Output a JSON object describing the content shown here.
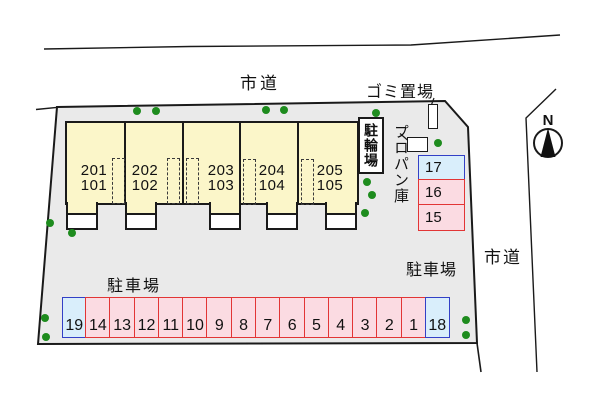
{
  "labels": {
    "road_top": "市道",
    "road_right": "市道",
    "garbage": "ゴミ置場",
    "bicycle_parking": "駐輪場",
    "propane": "プロパン庫",
    "parking_area_left": "駐車場",
    "parking_area_right": "駐車場",
    "compass_north": "N"
  },
  "building": {
    "units": [
      {
        "upper": "201",
        "lower": "101"
      },
      {
        "upper": "202",
        "lower": "102"
      },
      {
        "upper": "203",
        "lower": "103"
      },
      {
        "upper": "204",
        "lower": "104"
      },
      {
        "upper": "205",
        "lower": "105"
      }
    ]
  },
  "parking": {
    "side_spaces": [
      {
        "number": "17",
        "color": "blue"
      },
      {
        "number": "16",
        "color": "red"
      },
      {
        "number": "15",
        "color": "red"
      }
    ],
    "bottom_spaces": [
      {
        "number": "19",
        "color": "blue"
      },
      {
        "number": "14",
        "color": "red"
      },
      {
        "number": "13",
        "color": "red"
      },
      {
        "number": "12",
        "color": "red"
      },
      {
        "number": "11",
        "color": "red"
      },
      {
        "number": "10",
        "color": "red"
      },
      {
        "number": "9",
        "color": "red"
      },
      {
        "number": "8",
        "color": "red"
      },
      {
        "number": "7",
        "color": "red"
      },
      {
        "number": "6",
        "color": "red"
      },
      {
        "number": "5",
        "color": "red"
      },
      {
        "number": "4",
        "color": "red"
      },
      {
        "number": "3",
        "color": "red"
      },
      {
        "number": "2",
        "color": "red"
      },
      {
        "number": "1",
        "color": "red"
      },
      {
        "number": "18",
        "color": "blue"
      }
    ]
  },
  "colors": {
    "site_fill": "#EAEAEA",
    "building_fill": "#FBF6C9",
    "red_border": "#E23535",
    "red_fill": "#FBDBE2",
    "blue_border": "#3340C6",
    "blue_fill": "#D9EEFB",
    "tree_green": "#1E8C1E",
    "line": "#1a1a1a"
  }
}
